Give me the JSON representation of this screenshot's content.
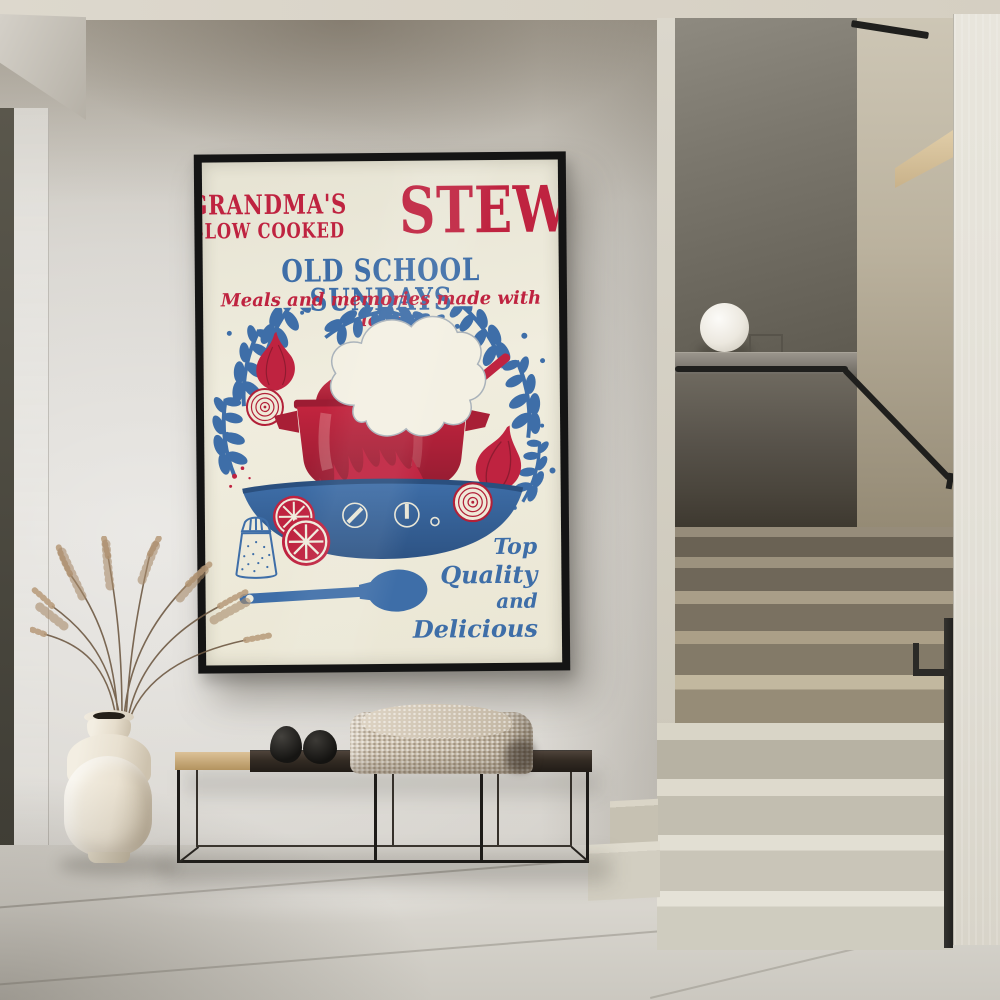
{
  "scene": {
    "description": "Minimalist concrete hallway with a framed vintage kitchen poster above a black metal bench, a ceramic vase with dried pampas grass, and a terrazzo staircase with a black handrail and a white sphere lamp",
    "objects": [
      "framed-poster",
      "terrazzo-staircase",
      "black-handrail",
      "sphere-lamp",
      "bench",
      "knitted-throw",
      "decorative-stones",
      "ceramic-vase",
      "pampas-grass",
      "tiled-floor"
    ],
    "colors": {
      "wall": "#d3d0ca",
      "ceiling": "#d8d3c8",
      "floor": "#d5d2cb",
      "right_column": "#e4e1d8",
      "stair_upper": "#6f6a61",
      "stair_lower": "#dbd7cb",
      "handrail": "#1f1f1d",
      "bench_frame": "#1d1b18",
      "bench_wood_dark": "#2c2620",
      "bench_wood_oak": "#c9a878",
      "vase": "#efe9dd",
      "lamp": "#f6f4ee"
    }
  },
  "poster": {
    "title_top": "GRANDMA'S",
    "title_sub": "SLOW COOKED",
    "title_main": "STEW",
    "headline": "OLD SCHOOL SUNDAYS",
    "tagline": "Meals and memories made with love",
    "footer_lines": [
      "Top",
      "Quality",
      "and",
      "Delicious"
    ],
    "colors": {
      "red": "#bf2340",
      "blue": "#3e6ea8",
      "background": "#efecdc",
      "frame": "#141414"
    },
    "illustration_items": [
      "steam-cloud",
      "red-cooking-pot",
      "ladle",
      "flames",
      "blue-serving-bowl",
      "stove-dials",
      "leaf-wreath",
      "red-onion-whole",
      "red-onion-sliced",
      "citrus-slices",
      "salt-shaker",
      "blue-spoon"
    ]
  }
}
